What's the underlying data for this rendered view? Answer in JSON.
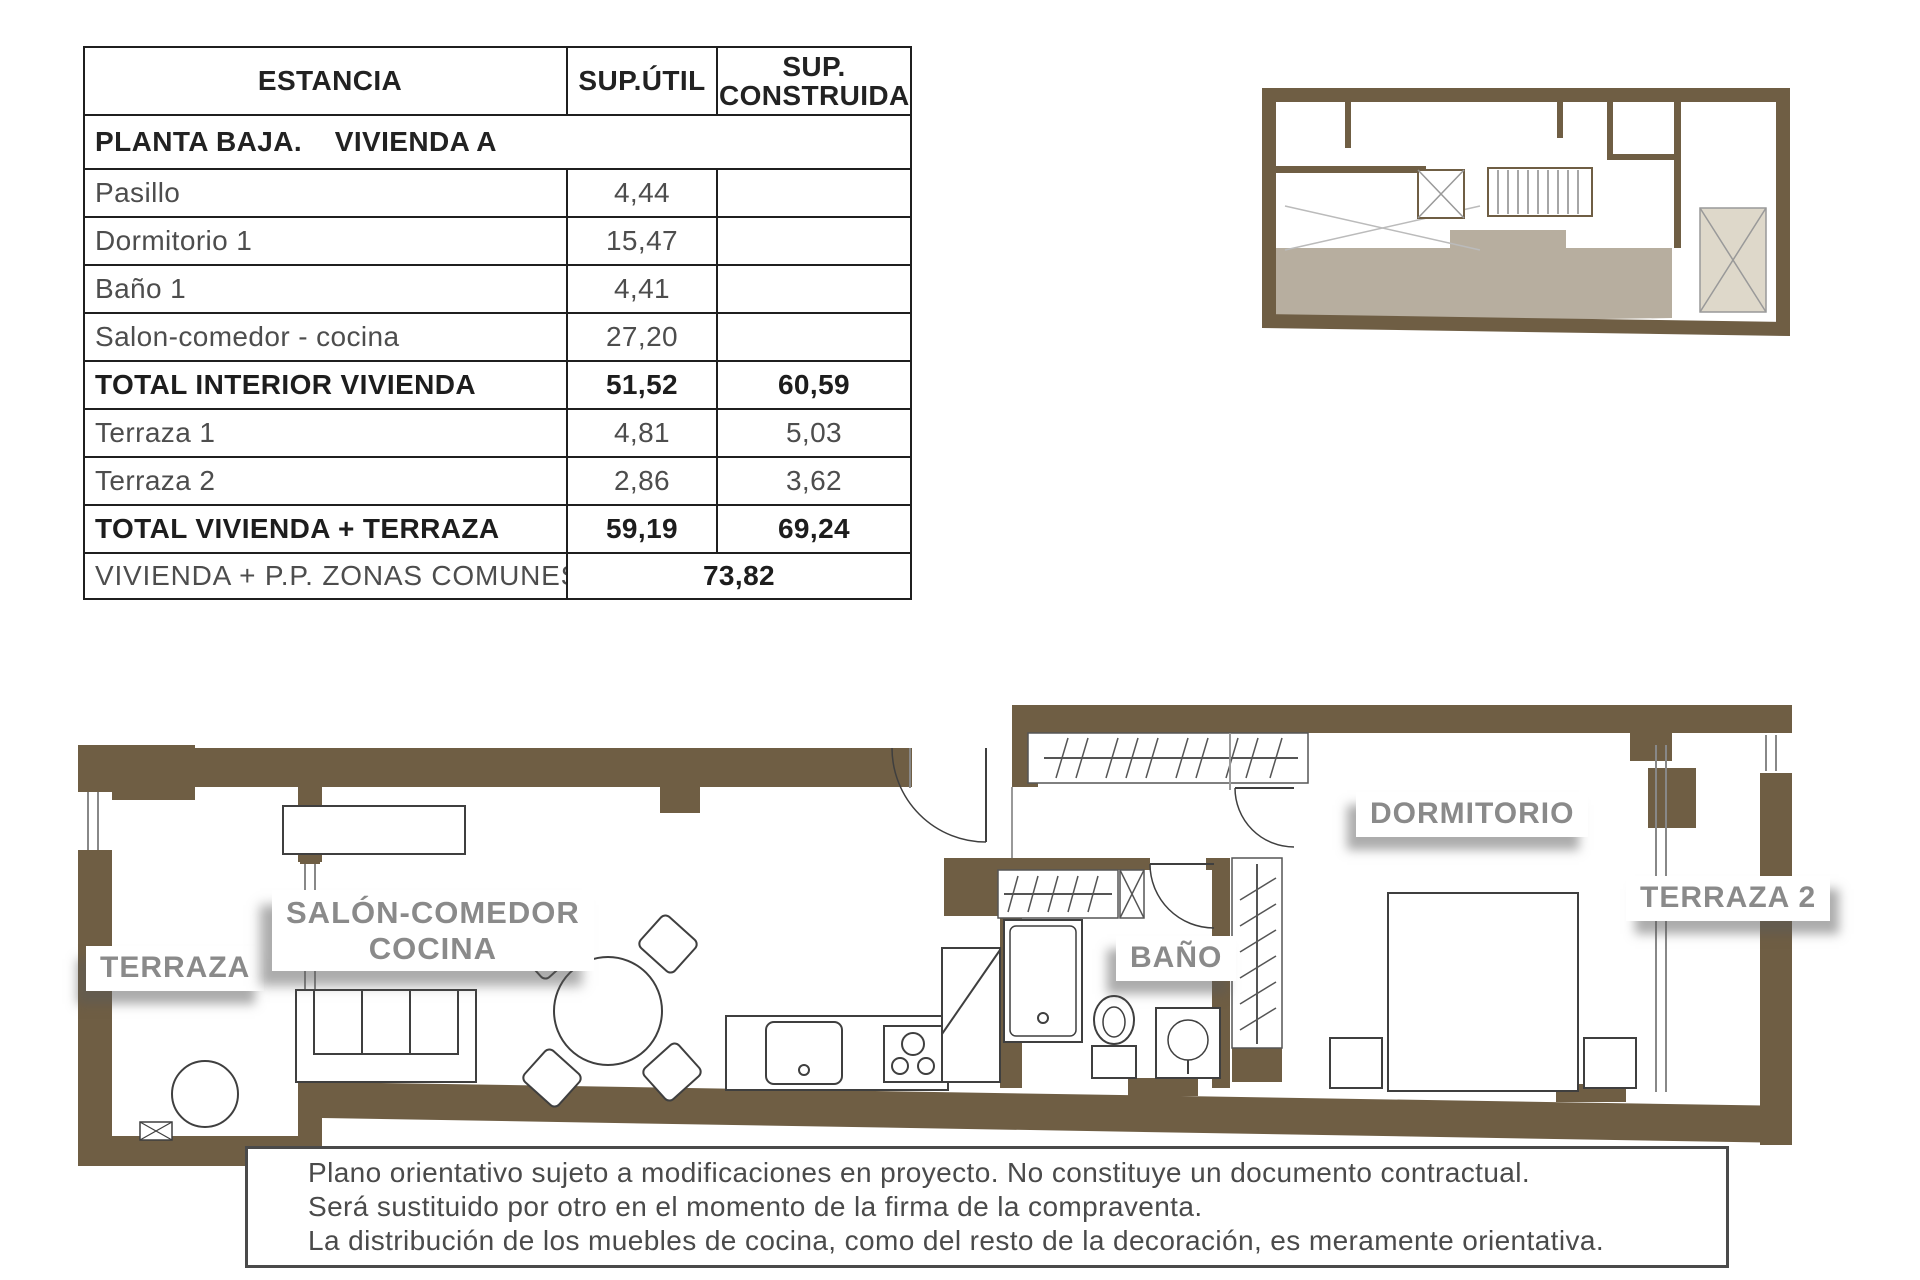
{
  "colors": {
    "wall_brown": "#6f5e44",
    "unit_highlight": "#b7ae9f",
    "patio_fill": "#ded8ca",
    "label_gray": "#8a8a8a",
    "line_dark": "#3f3f3f"
  },
  "table": {
    "headers": {
      "estancia": "ESTANCIA",
      "sup_util": "SUP.ÚTIL",
      "sup_construida": "SUP. CONSTRUIDA"
    },
    "section_title": "PLANTA BAJA.    VIVIENDA A",
    "rows": [
      {
        "label": "Pasillo",
        "util": "4,44",
        "construida": ""
      },
      {
        "label": "Dormitorio 1",
        "util": "15,47",
        "construida": ""
      },
      {
        "label": "Baño 1",
        "util": "4,41",
        "construida": ""
      },
      {
        "label": "Salon-comedor - cocina",
        "util": "27,20",
        "construida": ""
      },
      {
        "label": "TOTAL INTERIOR VIVIENDA",
        "util": "51,52",
        "construida": "60,59"
      },
      {
        "label": "Terraza 1",
        "util": "4,81",
        "construida": "5,03"
      },
      {
        "label": "Terraza 2",
        "util": "2,86",
        "construida": "3,62"
      },
      {
        "label": "TOTAL VIVIENDA + TERRAZA",
        "util": "59,19",
        "construida": "69,24"
      }
    ],
    "footer": {
      "label": "VIVIENDA + P.P. ZONAS COMUNES",
      "value": "73,82"
    }
  },
  "plan_labels": {
    "terraza": "TERRAZA",
    "salon_line1": "SALÓN-COMEDOR",
    "salon_line2": "COCINA",
    "bano": "BAÑO",
    "dormitorio": "DORMITORIO",
    "terraza2": "TERRAZA 2"
  },
  "disclaimer": {
    "line1": "Plano orientativo sujeto a modificaciones en proyecto. No constituye un documento contractual.",
    "line2": "Será sustituido por otro en el momento de la firma de la compraventa.",
    "line3": "La distribución de los muebles de cocina, como del resto de la decoración, es meramente orientativa."
  }
}
